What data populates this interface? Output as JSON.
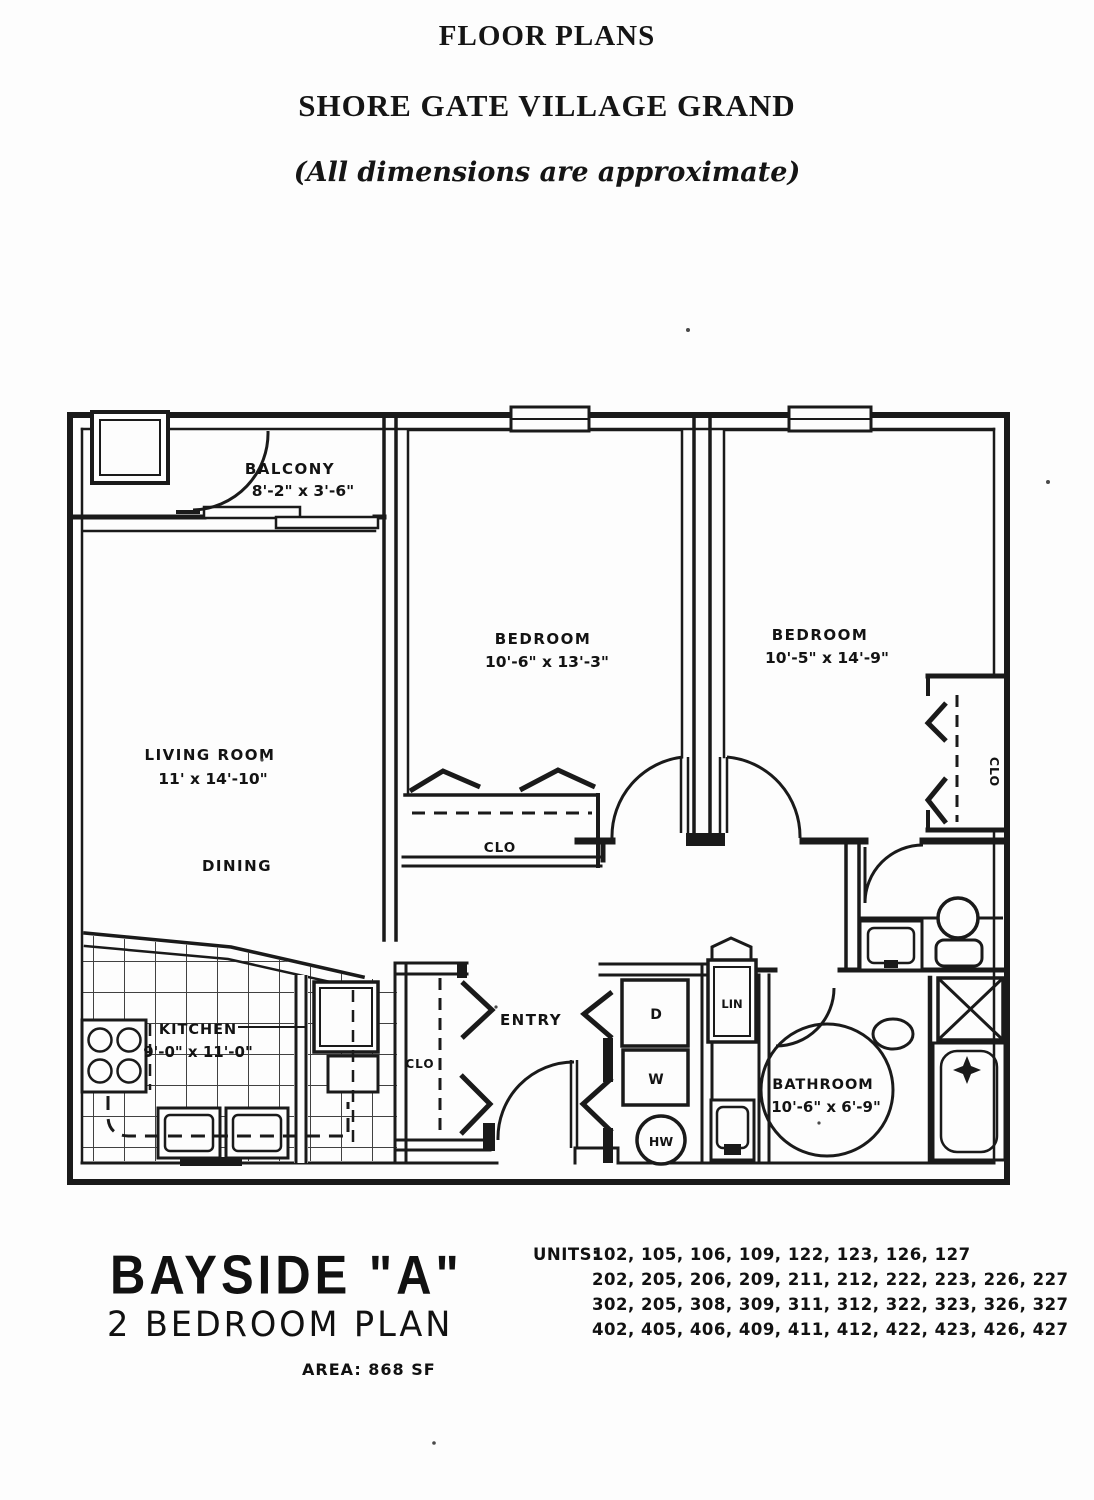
{
  "header": {
    "line1": "FLOOR PLANS",
    "line2": "SHORE GATE VILLAGE GRAND",
    "line3": "(All dimensions are approximate)"
  },
  "plan": {
    "balcony": {
      "name": "BALCONY",
      "dims": "8'-2\" x 3'-6\""
    },
    "living_room": {
      "name": "LIVING ROOM",
      "dims": "11' x 14'-10\""
    },
    "dining": {
      "name": "DINING"
    },
    "bedroom1": {
      "name": "BEDROOM",
      "dims": "10'-6\" x 13'-3\""
    },
    "bedroom2": {
      "name": "BEDROOM",
      "dims": "10'-5\" x 14'-9\""
    },
    "kitchen": {
      "name": "KITCHEN",
      "dims": "9'-0\" x 11'-0\""
    },
    "bathroom": {
      "name": "BATHROOM",
      "dims": "10'-6\" x 6'-9\""
    },
    "entry": {
      "name": "ENTRY"
    },
    "closet_bedroom1": "CLO",
    "closet_bedroom2": "CLO",
    "closet_entry": "CLO",
    "linen": "LIN",
    "dryer": "D",
    "washer": "W",
    "water_heater": "HW"
  },
  "footer": {
    "plan_name": "BAYSIDE \"A\"",
    "plan_type": "2 BEDROOM PLAN",
    "area": "AREA: 868 SF",
    "units_label": "UNITS:",
    "units": [
      "102, 105, 106, 109, 122, 123, 126, 127",
      "202, 205, 206, 209, 211, 212, 222, 223, 226, 227",
      "302, 205, 308, 309, 311, 312, 322, 323, 326, 327",
      "402, 405, 406, 409, 411, 412, 422, 423, 426, 427"
    ]
  }
}
